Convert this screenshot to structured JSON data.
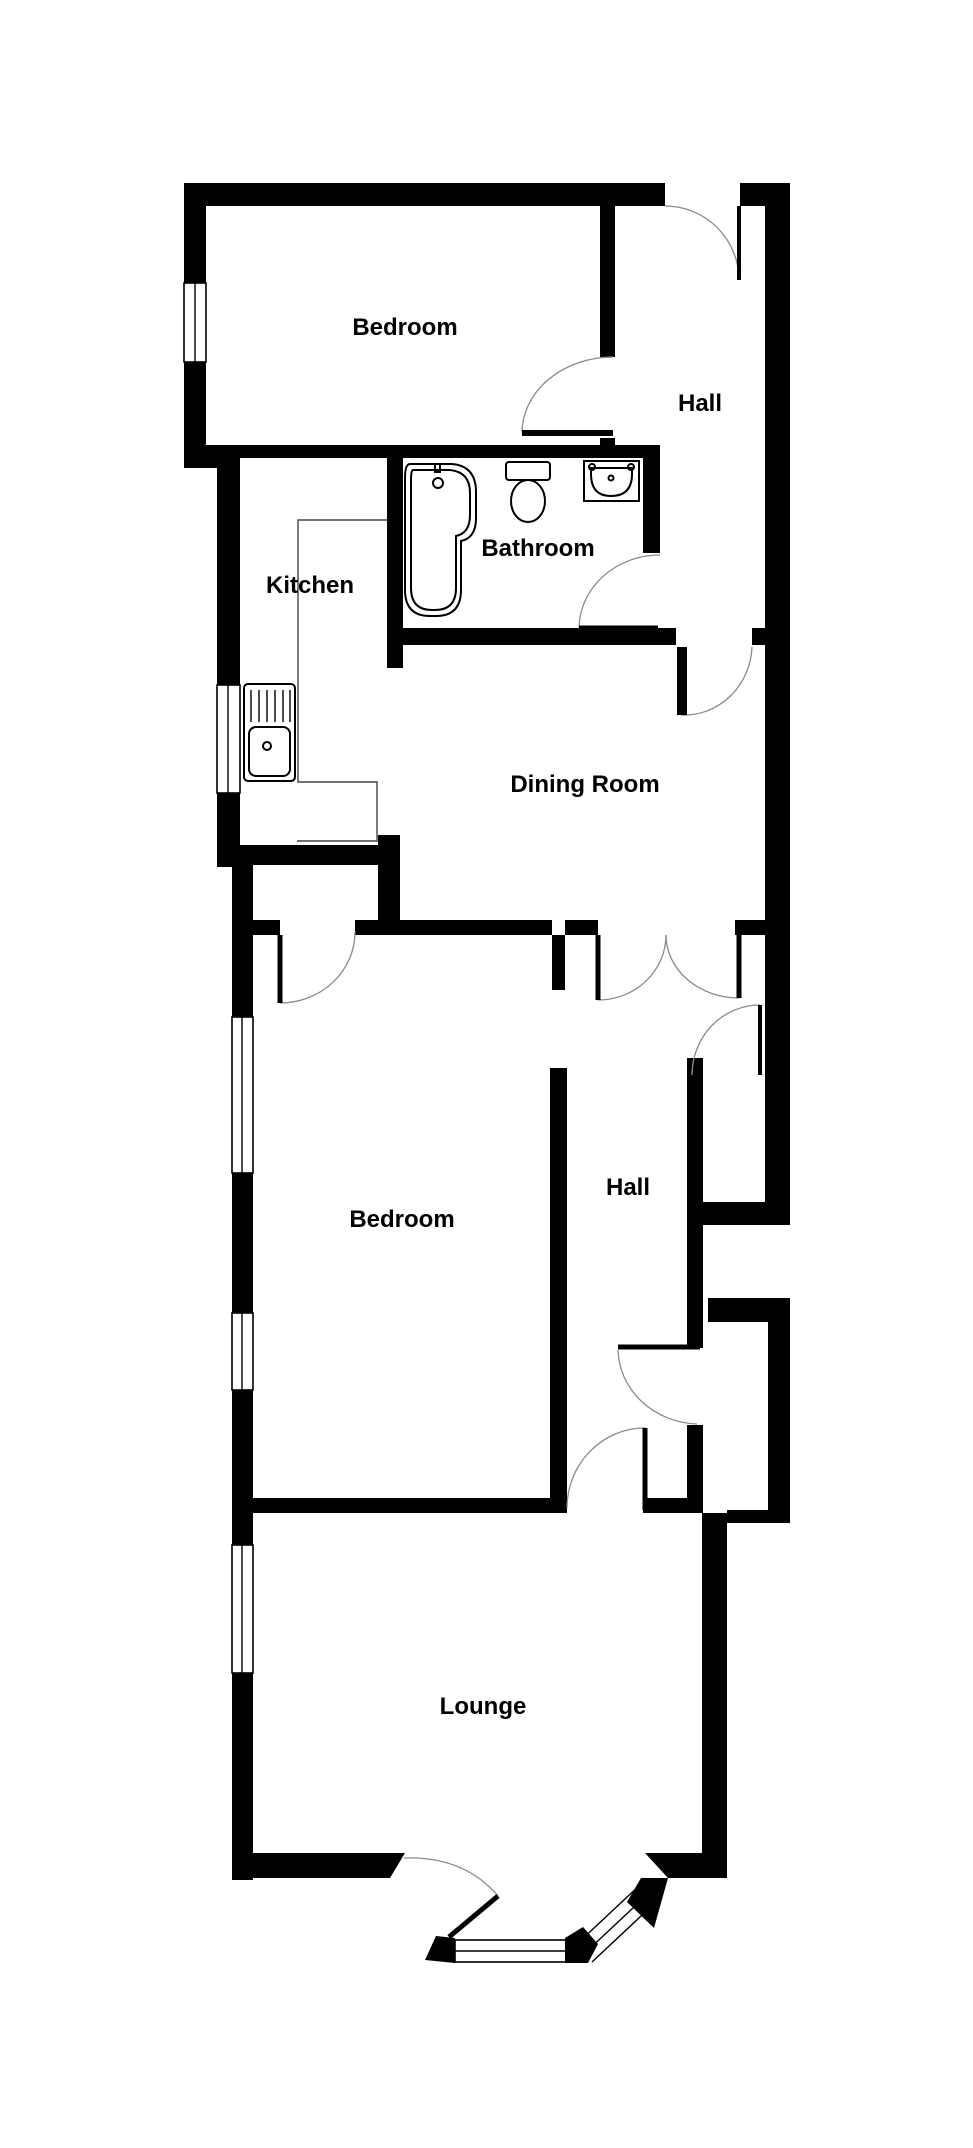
{
  "plan": {
    "background": "#ffffff",
    "wall_color": "#000000",
    "rooms": [
      {
        "id": "bedroom-1",
        "label": "Bedroom"
      },
      {
        "id": "hall-1",
        "label": "Hall"
      },
      {
        "id": "bathroom",
        "label": "Bathroom"
      },
      {
        "id": "kitchen",
        "label": "Kitchen"
      },
      {
        "id": "dining-room",
        "label": "Dining Room"
      },
      {
        "id": "bedroom-2",
        "label": "Bedroom"
      },
      {
        "id": "hall-2",
        "label": "Hall"
      },
      {
        "id": "lounge",
        "label": "Lounge"
      }
    ],
    "fixtures": [
      "bath",
      "toilet",
      "basin",
      "kitchen-sink",
      "kitchen-counter"
    ],
    "window_count": 7,
    "door_count": 10,
    "bay_window": true
  }
}
